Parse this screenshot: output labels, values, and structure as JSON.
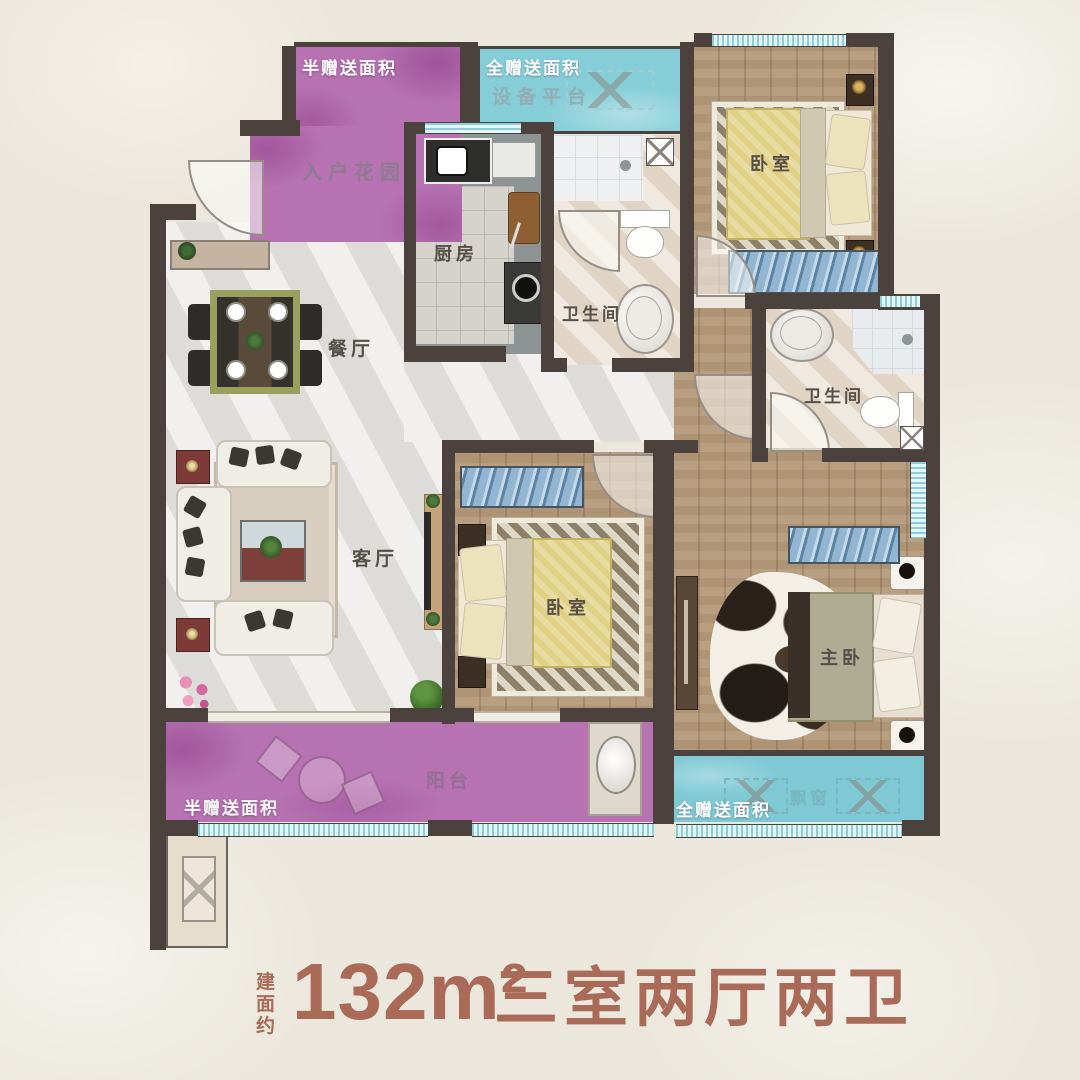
{
  "title": {
    "prefix": "建面约",
    "area": "132m²",
    "layout": "三室两厅两卫"
  },
  "annotations": {
    "garden_gift": "半赠送面积",
    "platform_gift": "全赠送面积",
    "balcony_gift": "半赠送面积",
    "bay_gift": "全赠送面积"
  },
  "rooms": {
    "entrance_garden": "入户花园",
    "equipment_platform": "设备平台",
    "kitchen": "厨房",
    "bathroom_top": "卫生间",
    "bathroom_right": "卫生间",
    "bedroom_top_right": "卧室",
    "bedroom_middle": "卧室",
    "master_bedroom": "主卧",
    "dining_room": "餐厅",
    "living_room": "客厅",
    "balcony": "阳台",
    "bay_window": "飘窗"
  },
  "colors": {
    "background": "#ebe7dc",
    "wall": "#4b423e",
    "gift_purple": "#b672b1",
    "gift_cyan": "#85ced8",
    "wood_floor": "#b49878",
    "marble_floor": "#e3e2df",
    "bath_floor": "#e8ddcf",
    "title_text": "#a96a57",
    "room_label": "#564f48"
  }
}
